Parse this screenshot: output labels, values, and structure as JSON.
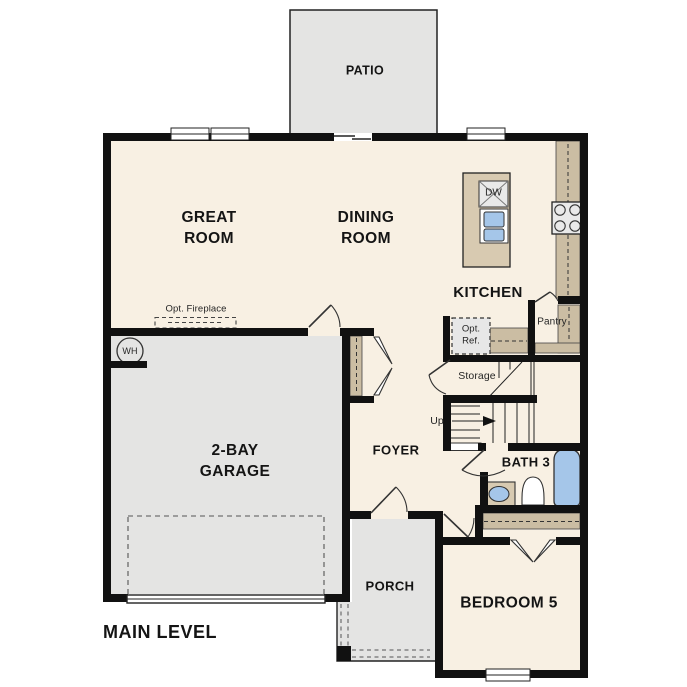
{
  "plan": {
    "level_label": "MAIN LEVEL",
    "rooms": {
      "patio": "PATIO",
      "great_room": "GREAT\nROOM",
      "dining_room": "DINING\nROOM",
      "kitchen": "KITCHEN",
      "pantry": "Pantry",
      "storage": "Storage",
      "foyer": "FOYER",
      "garage": "2-BAY\nGARAGE",
      "bath3": "BATH 3",
      "porch": "PORCH",
      "bedroom5": "BEDROOM 5"
    },
    "annotations": {
      "up": "Up",
      "opt_fireplace": "Opt. Fireplace",
      "opt_ref": "Opt.\nRef.",
      "dishwasher": "DW",
      "water_heater": "WH"
    },
    "colors": {
      "floor": "#f8f0e3",
      "concrete": "#e4e4e3",
      "counter": "#d8cab1",
      "counter2": "#cbbda3",
      "fixture": "#a5c6e9",
      "wall": "#111111",
      "appliance": "#e9e9e9"
    }
  }
}
